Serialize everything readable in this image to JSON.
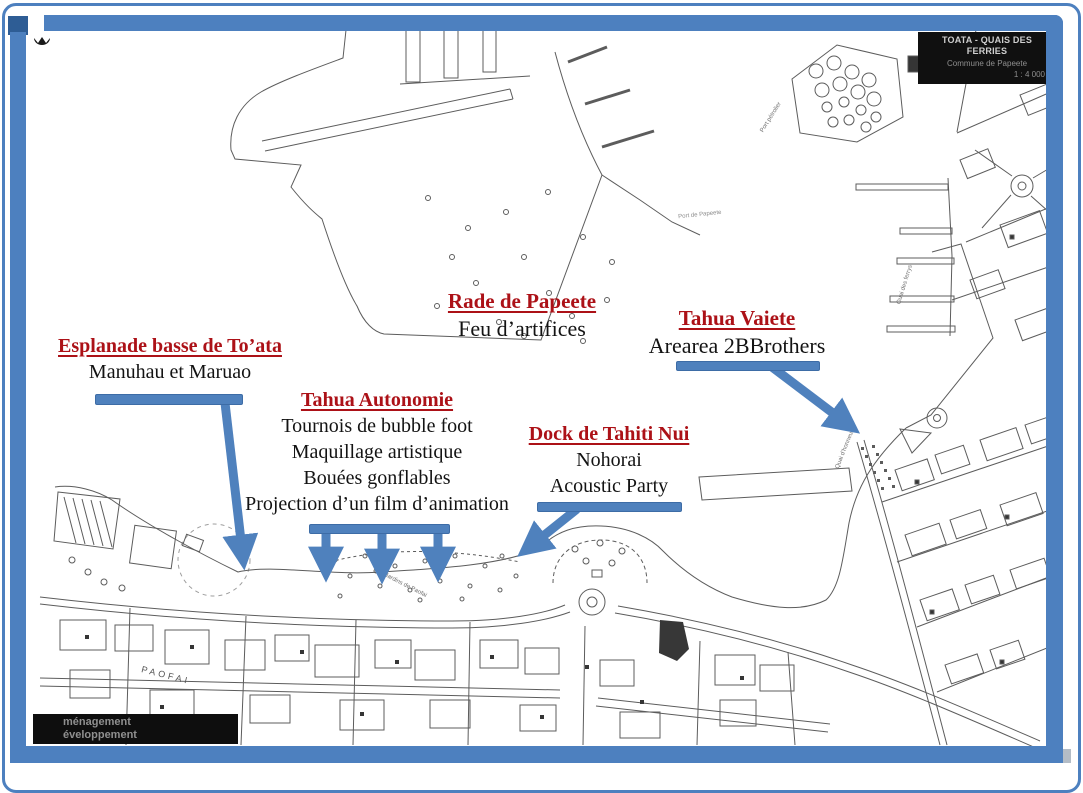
{
  "map": {
    "title_block": {
      "line1": "TOATA - QUAIS DES FERRIES",
      "line2": "Commune de Papeete",
      "line3": "1 : 4 000"
    },
    "credit_box": {
      "line1": "ménagement",
      "line2": "éveloppement"
    },
    "labels": [
      {
        "text": "PAOFAI"
      },
      {
        "text": "Les Jardins de Paofai"
      },
      {
        "text": "Port pétrolier"
      },
      {
        "text": "Quai des ferrys"
      },
      {
        "text": "Quai d’honneur"
      },
      {
        "text": "Port de Papeete"
      }
    ]
  },
  "annotations": [
    {
      "id": "esplanade",
      "title": "Esplanade basse de To’ata",
      "lines": [
        "Manuhau et Maruao"
      ]
    },
    {
      "id": "rade",
      "title": "Rade de Papeete",
      "lines": [
        "Feu d’artifices"
      ]
    },
    {
      "id": "vaiete",
      "title": "Tahua Vaiete",
      "lines": [
        "Arearea 2BBrothers"
      ]
    },
    {
      "id": "autonomie",
      "title": "Tahua Autonomie",
      "lines": [
        "Tournois de bubble foot",
        "Maquillage artistique",
        "Bouées gonflables",
        "Projection d’un film d’animation"
      ]
    },
    {
      "id": "dock",
      "title": "Dock de Tahiti Nui",
      "lines": [
        "Nohorai",
        "Acoustic Party"
      ]
    }
  ],
  "colors": {
    "frame_blue": "#4d80bf",
    "accent_blue": "#4f81bd",
    "heading_red": "#ac1117",
    "map_ink": "#3f3f3f"
  }
}
